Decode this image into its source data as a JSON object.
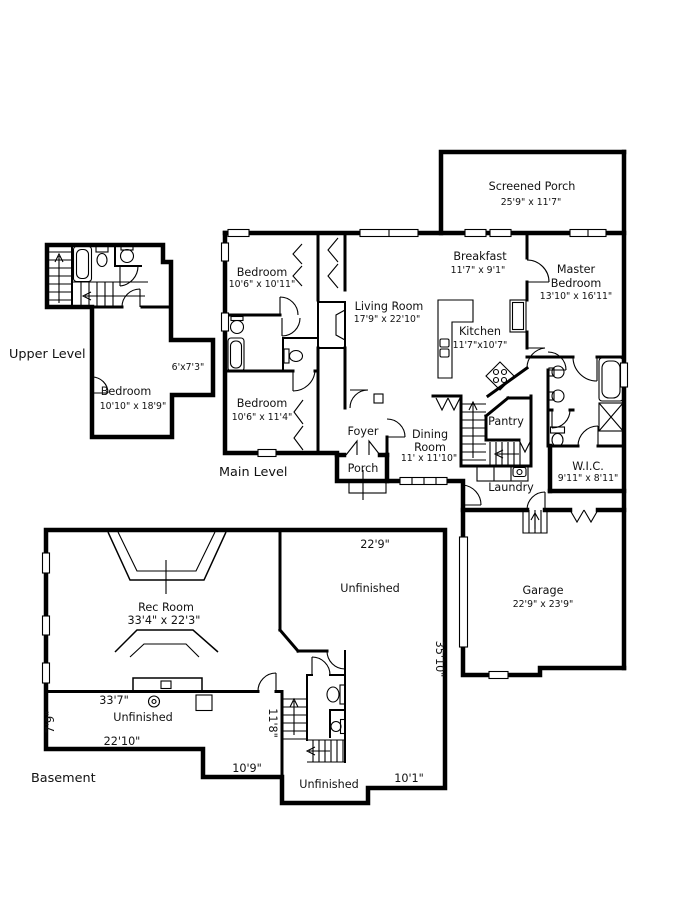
{
  "levels": {
    "upper": "Upper Level",
    "main": "Main Level",
    "basement": "Basement"
  },
  "rooms": {
    "screened_porch": {
      "name": "Screened Porch",
      "dims": "25'9\" x 11'7\""
    },
    "breakfast": {
      "name": "Breakfast",
      "dims": "11'7\" x 9'1\""
    },
    "master_bedroom": {
      "line1": "Master",
      "line2": "Bedroom",
      "dims": "13'10\" x 16'11\""
    },
    "bedroom_front": {
      "name": "Bedroom",
      "dims": "10'6\" x 10'11\""
    },
    "living_room": {
      "name": "Living Room",
      "dims": "17'9\" x 22'10\""
    },
    "kitchen": {
      "name": "Kitchen",
      "dims": "11'7\"x10'7\""
    },
    "bedroom_back": {
      "name": "Bedroom",
      "dims": "10'6\" x 11'4\""
    },
    "foyer": {
      "name": "Foyer"
    },
    "porch": {
      "name": "Porch"
    },
    "dining_room": {
      "line1": "Dining",
      "line2": "Room",
      "dims": "11' x 11'10\""
    },
    "pantry": {
      "name": "Pantry"
    },
    "laundry": {
      "name": "Laundry"
    },
    "wic": {
      "name": "W.I.C.",
      "dims": "9'11\" x 8'11\""
    },
    "garage": {
      "name": "Garage",
      "dims": "22'9\" x 23'9\""
    },
    "upper_bedroom": {
      "name": "Bedroom",
      "dims": "10'10\" x 18'9\""
    },
    "upper_nook": {
      "dims": "6'x7'3\""
    },
    "rec_room": {
      "name": "Rec Room",
      "dims": "33'4\" x 22'3\""
    },
    "unfinished_upper": {
      "name": "Unfinished"
    },
    "unfinished_left": {
      "name": "Unfinished"
    },
    "unfinished_lower": {
      "name": "Unfinished"
    }
  },
  "basement_dimensions": {
    "top_width": "22'9\"",
    "right_height": "35'10\"",
    "left_width": "33'7\"",
    "left_height": "7'9\"",
    "lower_left_width": "22'10\"",
    "stairwell_height": "11'8\"",
    "notch_width": "10'9\"",
    "lower_right_width": "10'1\""
  },
  "colors": {
    "wall": "#000000",
    "background": "#ffffff",
    "text": "#111111"
  }
}
